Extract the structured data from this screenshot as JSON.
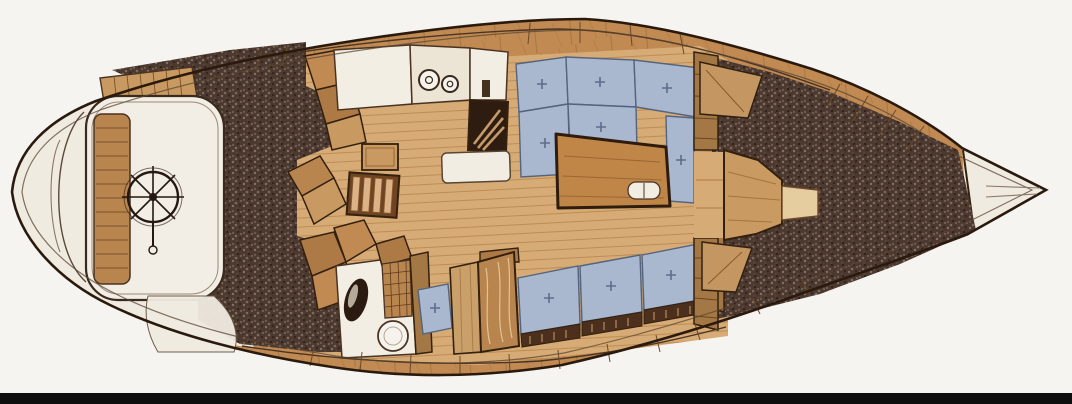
{
  "figure": {
    "title": "Sailboat interior layout plan, top-down view, bow pointing right",
    "type": "yacht accommodation plan illustration",
    "orientation": "bow-right, stern-left"
  },
  "regions": {
    "stern_deck": "Stern deck and transom platform",
    "cockpit": "Cockpit with helm seat and steering wheel",
    "steering_wheel": "Ship steering wheel with spokes",
    "helm_bench": "Slatted cockpit bench seat",
    "side_decks": "Dark non-skid side deck / seat areas (stippled)",
    "companionway": "Companionway ladder steps into cabin",
    "lockers": "Angled cockpit and companionway lockers",
    "galley": "Galley with counters, two-burner stove, sink and icebox",
    "stove": "Two-burner stove",
    "sink": "Galley sink counter",
    "icebox": "Icebox / cooler with hatch",
    "dinette": "U-shaped dinette with upholstered cushions",
    "salon_table": "Wooden salon table with twin cup recesses",
    "cabin_sole": "Planked wooden cabin sole",
    "head": "Head compartment with toilet, basin and grate locker",
    "toilet": "Marine toilet bowl",
    "basin": "Oval wash basin",
    "nav_seat": "Upholstered seat cushion",
    "chart_locker": "Wood chart table / locker panels",
    "settee": "Starboard settee with three cushions",
    "bulkhead": "Forward cabin bulkhead with door opening",
    "vberth_insert": "V-berth filler / forepeak platform",
    "forepeak": "Stippled forepeak area",
    "bow_locker": "White bow anchor locker and stem fitting"
  },
  "counts": {
    "stove_burners": 2,
    "dinette_cushions": 6,
    "settee_cushions": 3,
    "companionway_steps": 4,
    "wheel_spokes": 8
  },
  "colors": {
    "paper": "#f6f4f0",
    "stern_cream": "#f0ebe1",
    "hull_wood": "#c08a52",
    "floor_wood": "#d7ab75",
    "furniture_wood": "#b9854f",
    "cushion_blue": "#a9b7cf",
    "cushion_line": "#54647f",
    "stipple_dark": "#4b3930",
    "outline_dark": "#2a1a0e",
    "icebox_dark": "#2e1c10",
    "counter_white": "#f2eee3",
    "bottom_bar": "#0e0e0e"
  }
}
